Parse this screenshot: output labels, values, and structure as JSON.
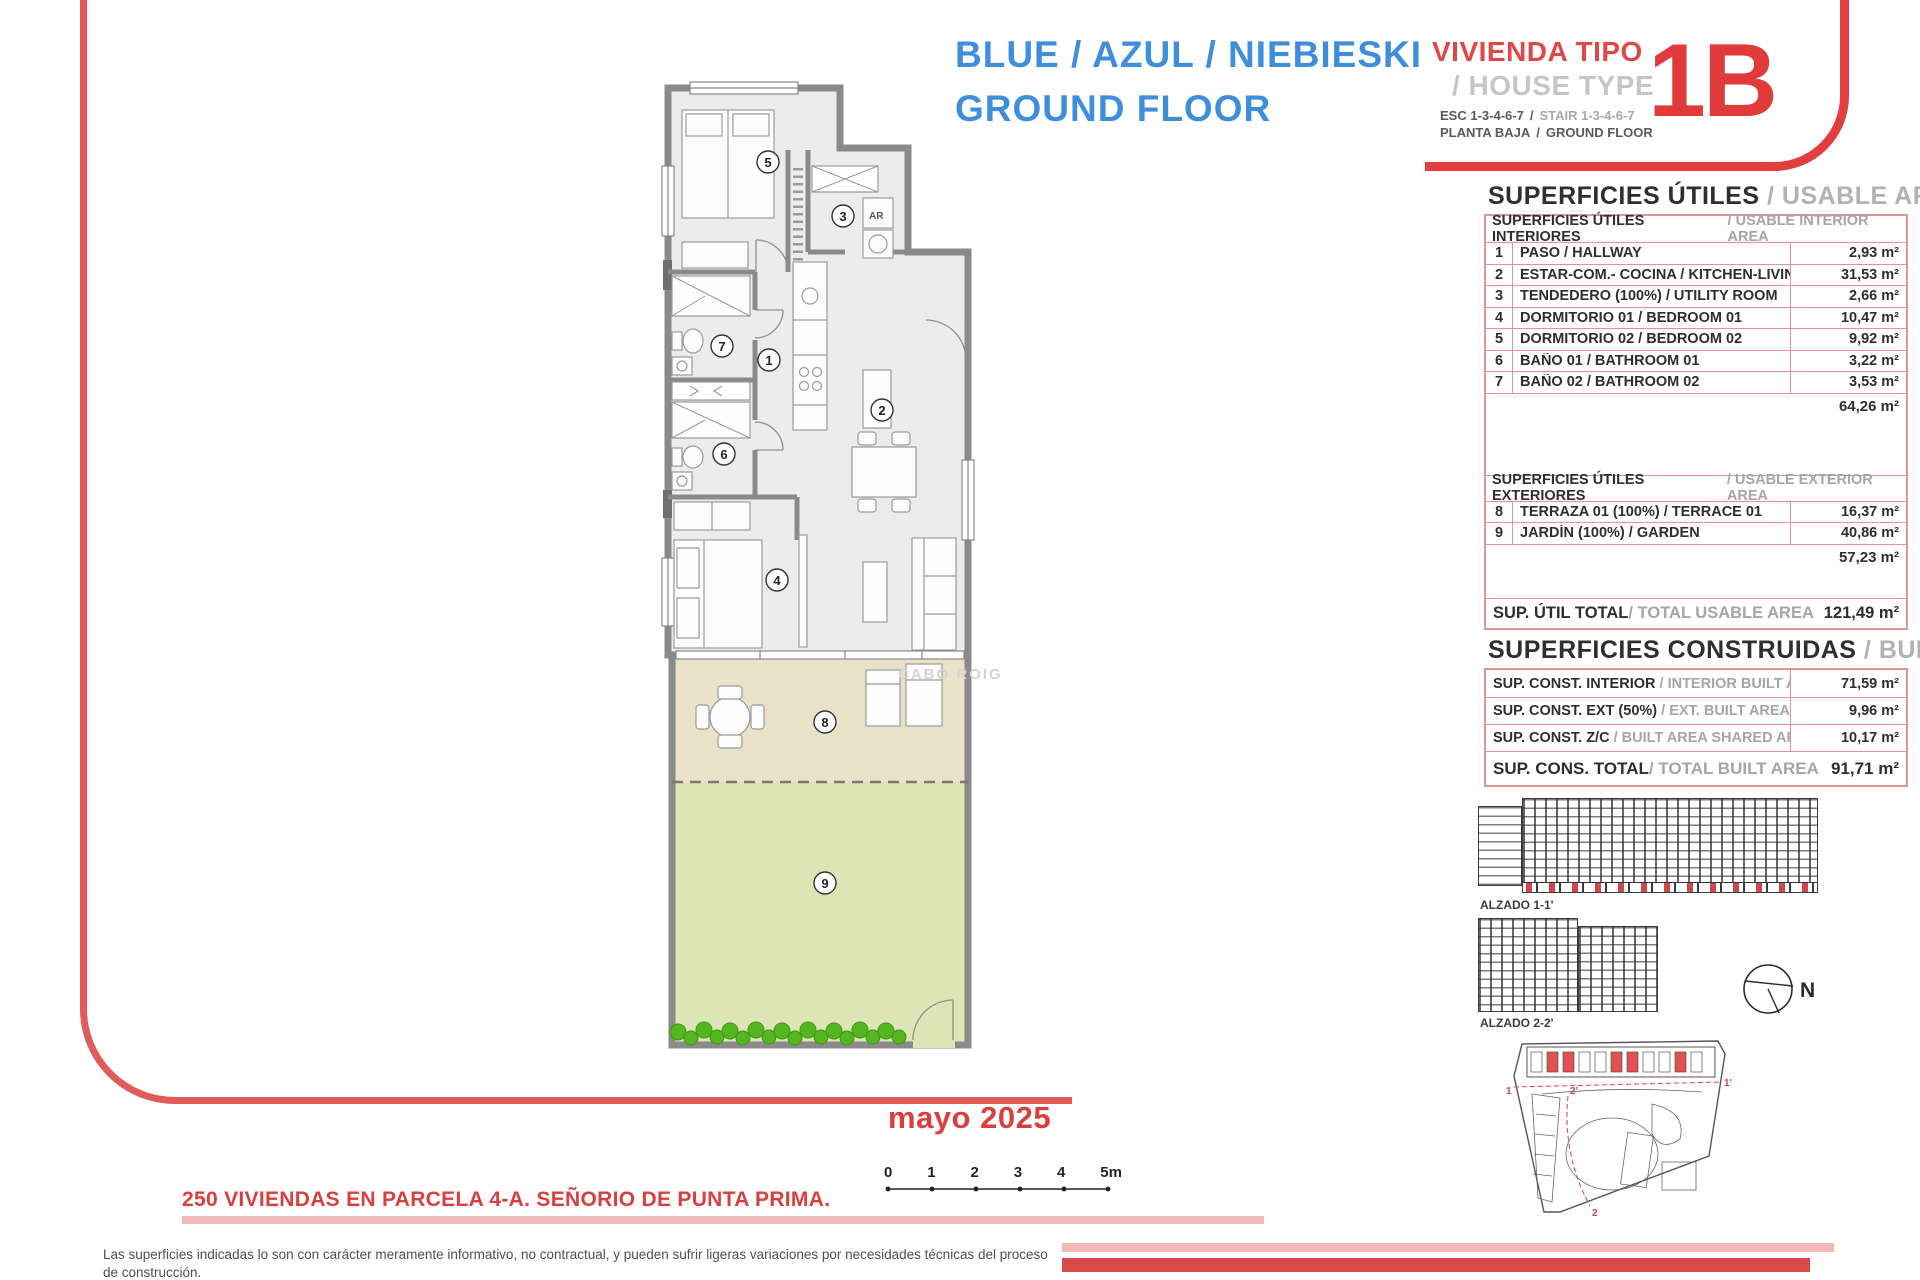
{
  "header": {
    "title_blue": "BLUE / AZUL / NIEBIESKI\nGROUND FLOOR",
    "vivienda_tipo": "VIVIENDA TIPO",
    "house_type": "/ HOUSE TYPE",
    "esc_es": "ESC 1-3-4-6-7",
    "esc_en": "STAIR 1-3-4-6-7",
    "planta_es": "PLANTA BAJA",
    "planta_en": "GROUND FLOOR",
    "sep": "/",
    "unit_code": "1B"
  },
  "usable_area": {
    "title_es": "SUPERFICIES ÚTILES",
    "title_en": " / USABLE AREA",
    "interior_header_es": "SUPERFICIES ÚTILES INTERIORES",
    "interior_header_en": " / USABLE INTERIOR AREA",
    "interior_rows": [
      {
        "num": "1",
        "label": "PASO / HALLWAY",
        "value": "2,93 m²"
      },
      {
        "num": "2",
        "label": "ESTAR-COM.- COCINA / KITCHEN-LIVING",
        "value": "31,53 m²"
      },
      {
        "num": "3",
        "label": "TENDEDERO (100%) / UTILITY ROOM",
        "value": "2,66 m²"
      },
      {
        "num": "4",
        "label": "DORMITORIO 01 / BEDROOM 01",
        "value": "10,47 m²"
      },
      {
        "num": "5",
        "label": "DORMITORIO 02 / BEDROOM 02",
        "value": "9,92 m²"
      },
      {
        "num": "6",
        "label": "BAÑO 01 / BATHROOM 01",
        "value": "3,22 m²"
      },
      {
        "num": "7",
        "label": "BAÑO 02 / BATHROOM 02",
        "value": "3,53 m²"
      }
    ],
    "interior_subtotal": "64,26 m²",
    "exterior_header_es": "SUPERFICIES ÚTILES EXTERIORES",
    "exterior_header_en": " / USABLE EXTERIOR AREA",
    "exterior_rows": [
      {
        "num": "8",
        "label": "TERRAZA 01 (100%) / TERRACE 01",
        "value": "16,37 m²"
      },
      {
        "num": "9",
        "label": "JARDÍN (100%) / GARDEN",
        "value": "40,86 m²"
      }
    ],
    "exterior_subtotal": "57,23 m²",
    "total_label_es": "SUP. ÚTIL TOTAL",
    "total_label_en": " / TOTAL USABLE AREA",
    "total_value": "121,49 m²"
  },
  "built_area": {
    "title_es": "SUPERFICIES CONSTRUIDAS",
    "title_en": " / BUILT AREA",
    "rows": [
      {
        "label_es": "SUP. CONST. INTERIOR",
        "label_en": " / INTERIOR BUILT AREA",
        "value": "71,59 m²"
      },
      {
        "label_es": "SUP. CONST. EXT (50%)",
        "label_en": " / EXT. BUILT AREA",
        "value": "9,96 m²"
      },
      {
        "label_es": "SUP. CONST. Z/C",
        "label_en": " / BUILT AREA SHARED AREAS",
        "value": "10,17 m²"
      }
    ],
    "total_label_es": "SUP. CONS. TOTAL",
    "total_label_en": " / TOTAL BUILT AREA",
    "total_value": "91,71 m²"
  },
  "plan": {
    "room_labels": [
      "1",
      "2",
      "3",
      "4",
      "5",
      "6",
      "7",
      "8",
      "9"
    ],
    "ar_label": "AR",
    "watermark": "CABO ROIG"
  },
  "drawings": {
    "alzado1_label": "ALZADO 1-1'",
    "alzado2_label": "ALZADO 2-2'",
    "north_label": "N",
    "site_markers": [
      "1",
      "1'",
      "2'",
      "2"
    ]
  },
  "footer": {
    "date": "mayo 2025",
    "project": "250 VIVIENDAS EN PARCELA 4-A. SEÑORIO DE PUNTA PRIMA.",
    "scale_ticks": [
      "0",
      "1",
      "2",
      "3",
      "4",
      "5m"
    ],
    "disclaimer_es": "Las superficies indicadas lo son con carácter meramente informativo, no contractual, y pueden sufrir ligeras variaciones por necesidades técnicas del proceso de construcción.",
    "disclaimer_en": "The indicated areas are for information purposes only, not contractual, and may vary slightly by technical requirements of the construction process."
  }
}
